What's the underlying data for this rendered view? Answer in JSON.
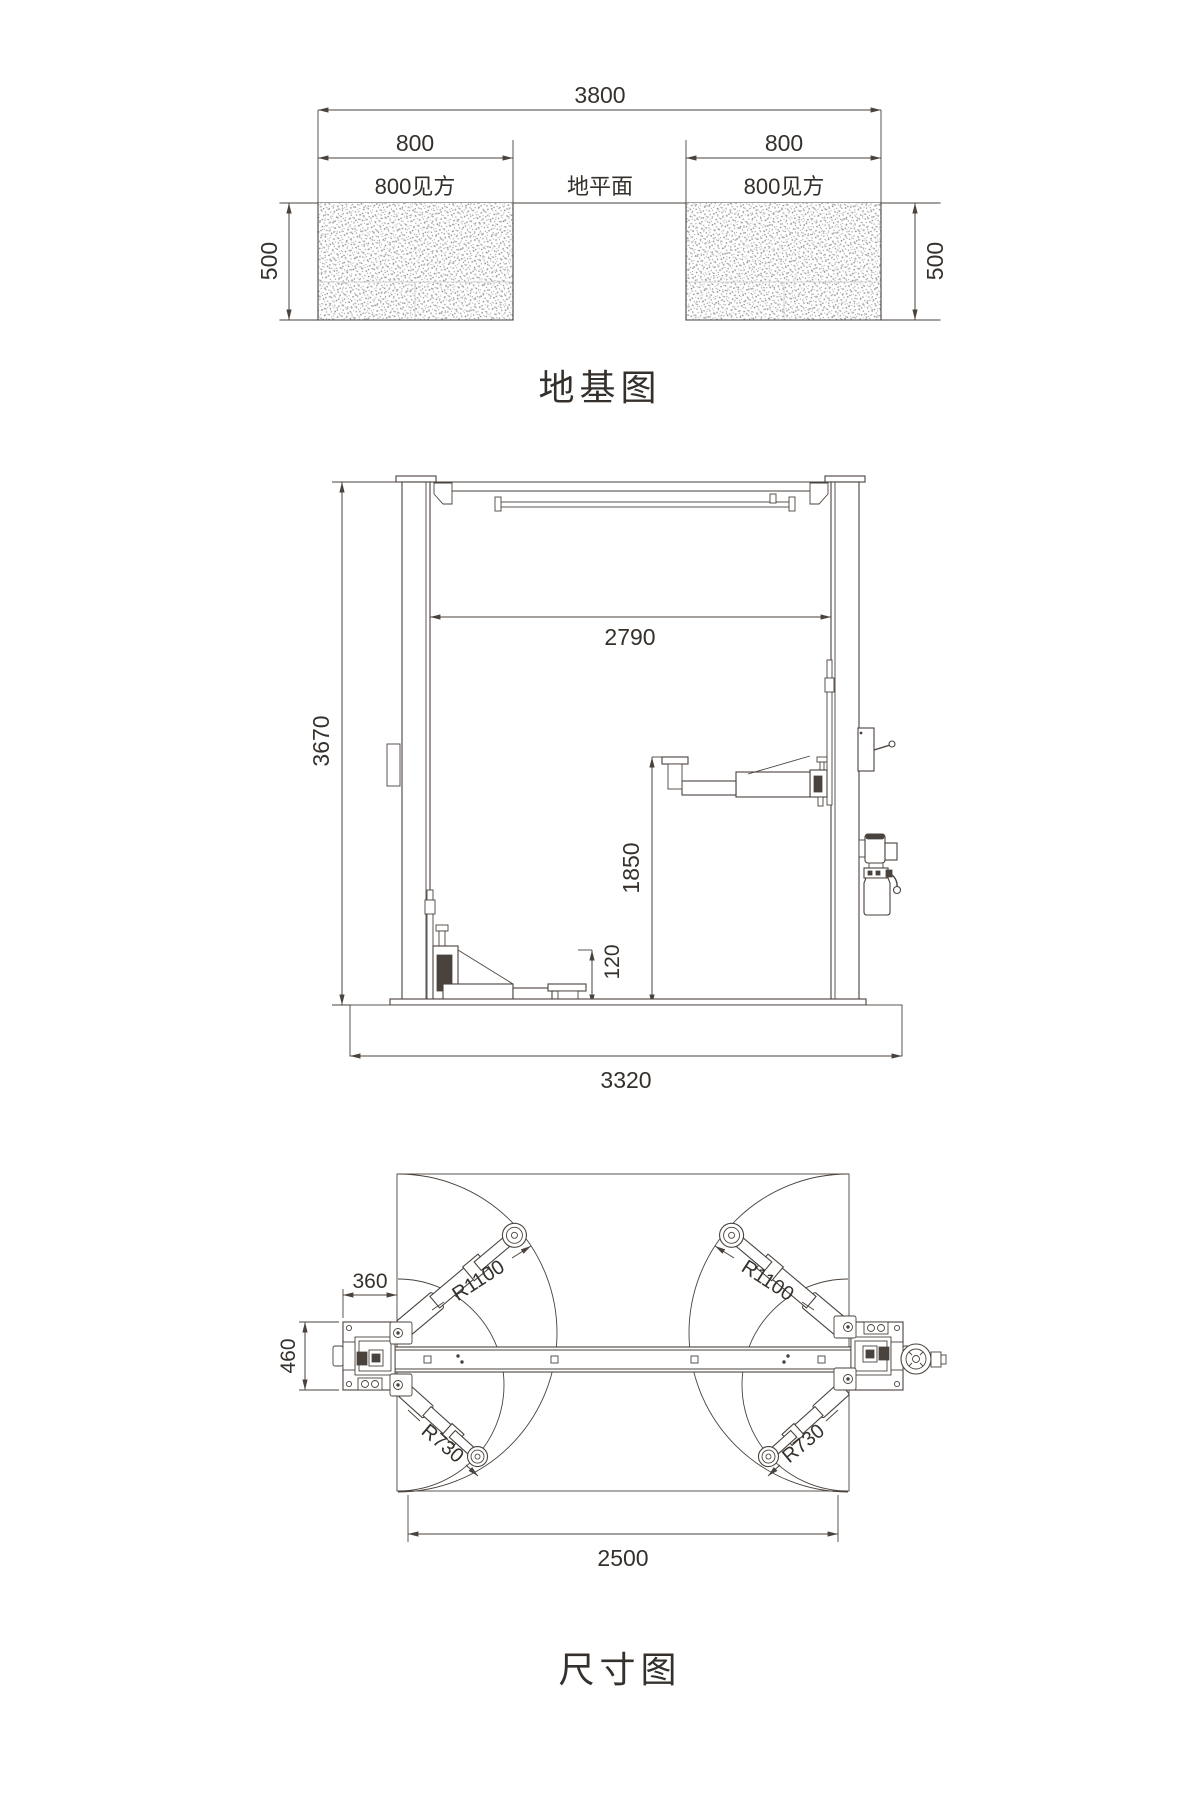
{
  "colors": {
    "line": "#4a423c",
    "text": "#35302b"
  },
  "foundation": {
    "title": "地基图",
    "dims": {
      "total": "3800",
      "pad_left": "800",
      "pad_right": "800",
      "depth_left": "500",
      "depth_right": "500"
    },
    "labels": {
      "pad_left": "800见方",
      "ground": "地平面",
      "pad_right": "800见方"
    }
  },
  "elevation": {
    "dims": {
      "height": "3670",
      "inner_width": "2790",
      "lift_height": "1850",
      "pad_min_height": "120",
      "base_width": "3320"
    }
  },
  "plan": {
    "title": "尺寸图",
    "dims": {
      "arm_front_left": "R1100",
      "arm_front_right": "R1100",
      "arm_rear_left": "R730",
      "arm_rear_right": "R730",
      "column_width": "360",
      "base_depth": "460",
      "span": "2500"
    }
  }
}
